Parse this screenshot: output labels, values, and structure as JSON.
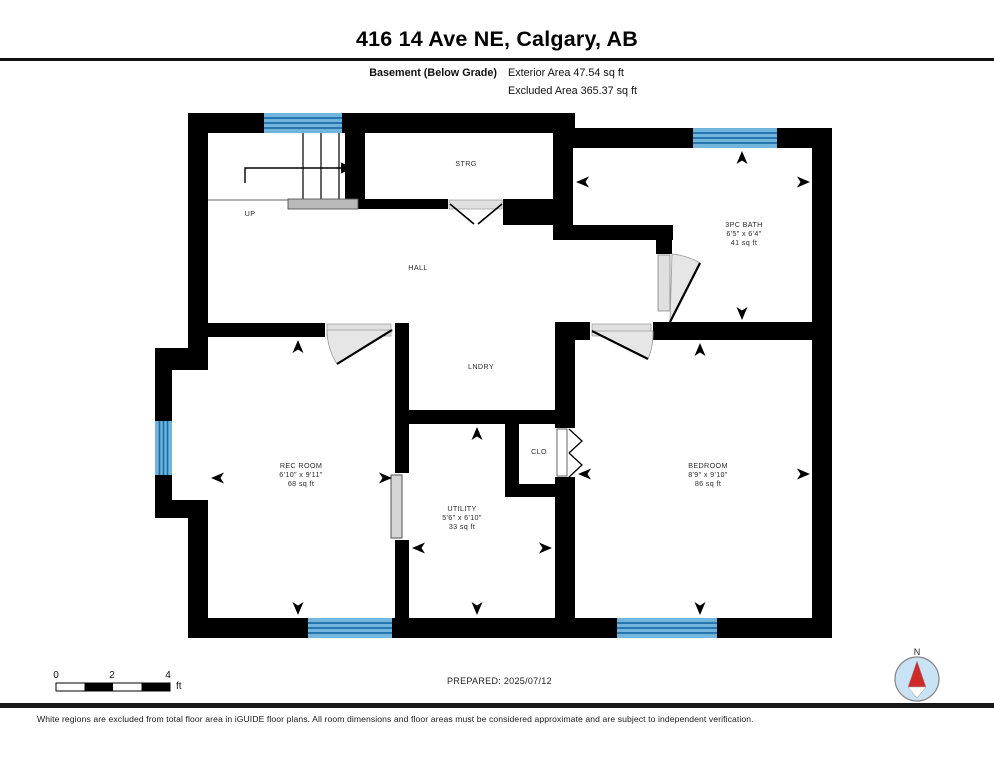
{
  "header": {
    "title": "416 14 Ave NE, Calgary, AB",
    "floor_label": "Basement (Below Grade)",
    "exterior_area": "Exterior Area 47.54 sq ft",
    "excluded_area": "Excluded Area 365.37 sq ft"
  },
  "rooms": {
    "strg": {
      "label": "STRG"
    },
    "hall": {
      "label": "HALL"
    },
    "lndry": {
      "label": "LNDRY"
    },
    "clo": {
      "label": "CLO"
    },
    "bath": {
      "label": "3PC BATH",
      "dims": "6'5\" x 6'4\"",
      "area": "41 sq ft"
    },
    "rec_room": {
      "label": "REC ROOM",
      "dims": "6'10\" x 9'11\"",
      "area": "68 sq ft"
    },
    "utility": {
      "label": "UTILITY",
      "dims": "5'6\" x 6'10\"",
      "area": "33 sq ft"
    },
    "bedroom": {
      "label": "BEDROOM",
      "dims": "8'9\" x 9'10\"",
      "area": "86 sq ft"
    }
  },
  "stairs": {
    "direction_label": "UP"
  },
  "scale_bar": {
    "tick_0": "0",
    "tick_2": "2",
    "tick_4": "4",
    "unit": "ft"
  },
  "compass": {
    "north_label": "N"
  },
  "footer": {
    "prepared": "PREPARED: 2025/07/12",
    "disclaimer": "White regions are excluded from total floor area in iGUIDE floor plans. All room dimensions and floor areas must be considered approximate and are subject to independent verification."
  },
  "colors": {
    "wall": "#000000",
    "window_fill": "#72b5dc",
    "window_frame": "#1d6ea8",
    "door_fill": "#e6e6e6",
    "landing_fill": "#b9b9b9",
    "compass_fill": "#c9e3f5",
    "compass_needle": "#cf2b2b"
  }
}
